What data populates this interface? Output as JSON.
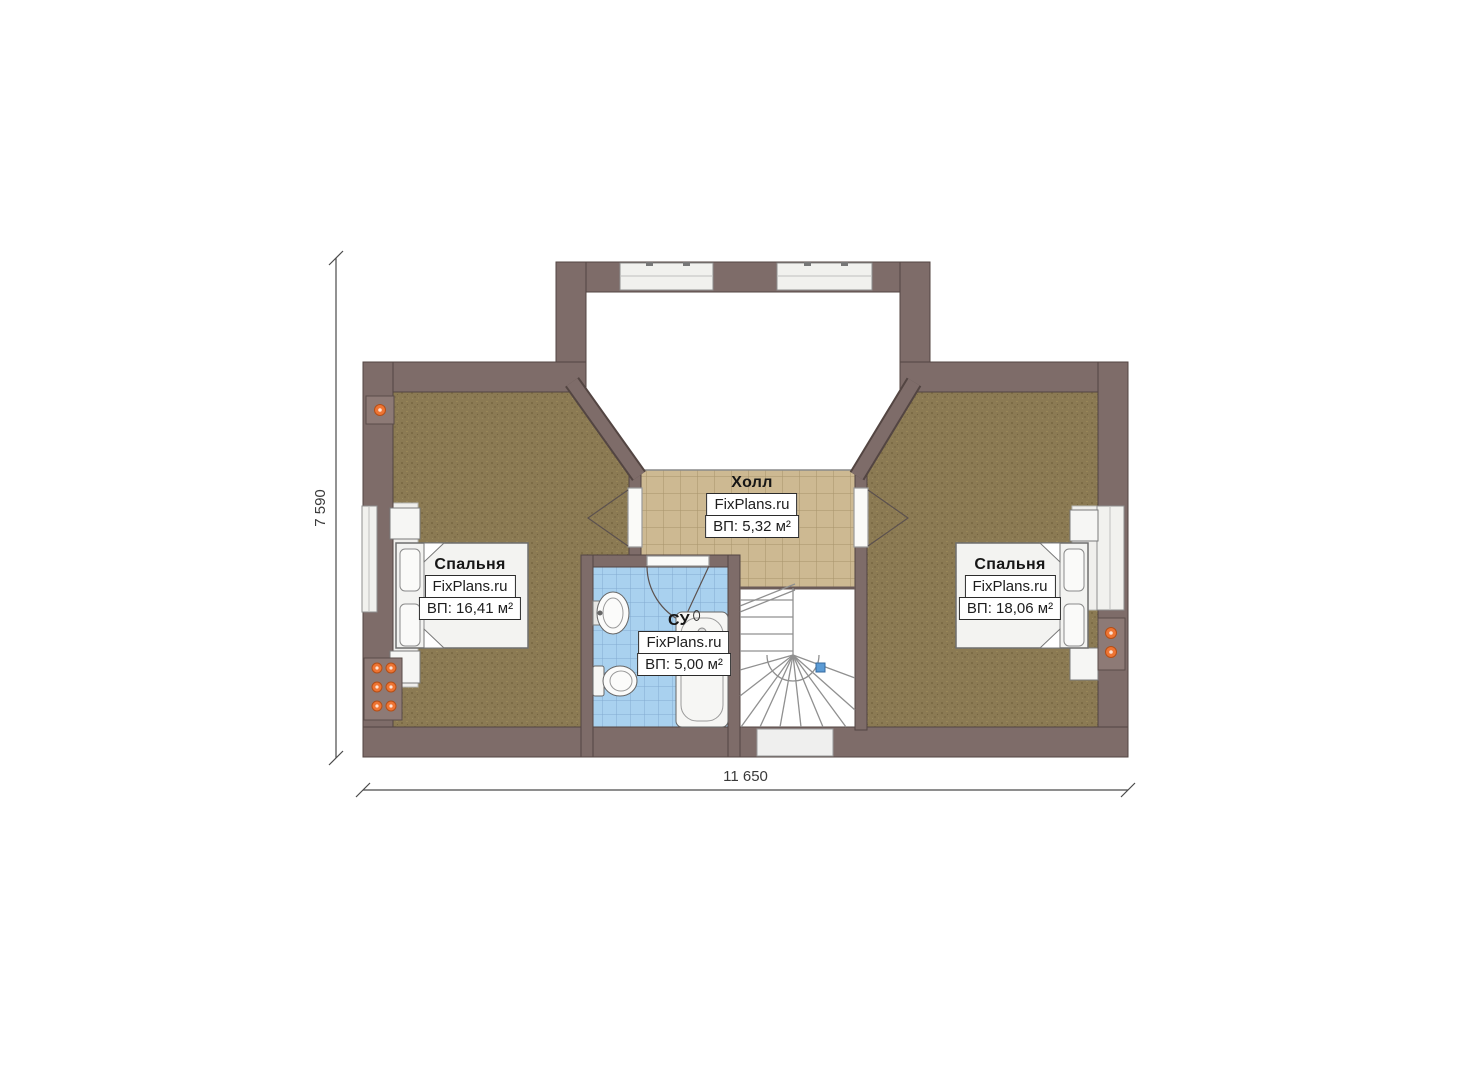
{
  "dimensions": {
    "width_label": "11 650",
    "height_label": "7 590"
  },
  "rooms": [
    {
      "id": "bedroom-left",
      "name": "Спальня",
      "brand": "FixPlans.ru",
      "area": "ВП: 16,41 м²"
    },
    {
      "id": "hall",
      "name": "Холл",
      "brand": "FixPlans.ru",
      "area": "ВП: 5,32 м²"
    },
    {
      "id": "bathroom",
      "name": "СУ",
      "brand": "FixPlans.ru",
      "area": "ВП: 5,00 м²"
    },
    {
      "id": "bedroom-right",
      "name": "Спальня",
      "brand": "FixPlans.ru",
      "area": "ВП: 18,06 м²"
    }
  ],
  "colors": {
    "wall": "#7e6c69",
    "wall_outline": "#534542",
    "bedroom_floor": "#8b7a53",
    "hall_tile": "#cdb992",
    "bath_tile": "#a9d1ef",
    "fixture_orange": "#ed7133",
    "stair_line": "#909090",
    "dimension_line": "#4a4a4a"
  }
}
